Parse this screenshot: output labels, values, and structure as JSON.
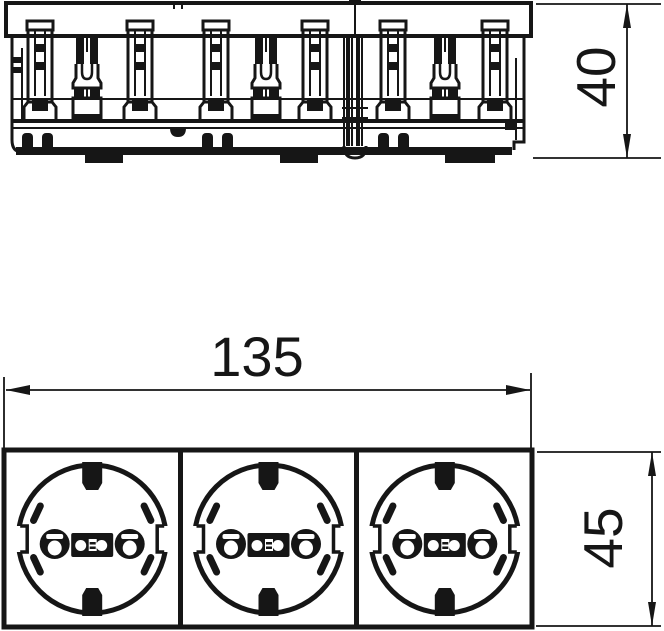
{
  "page": {
    "background": "#ffffff",
    "line_color": "#161616"
  },
  "top_view": {
    "depth_dimension_label": "40"
  },
  "front_view": {
    "socket_count": 3,
    "width_dimension_label": "135",
    "height_dimension_label": "45"
  }
}
